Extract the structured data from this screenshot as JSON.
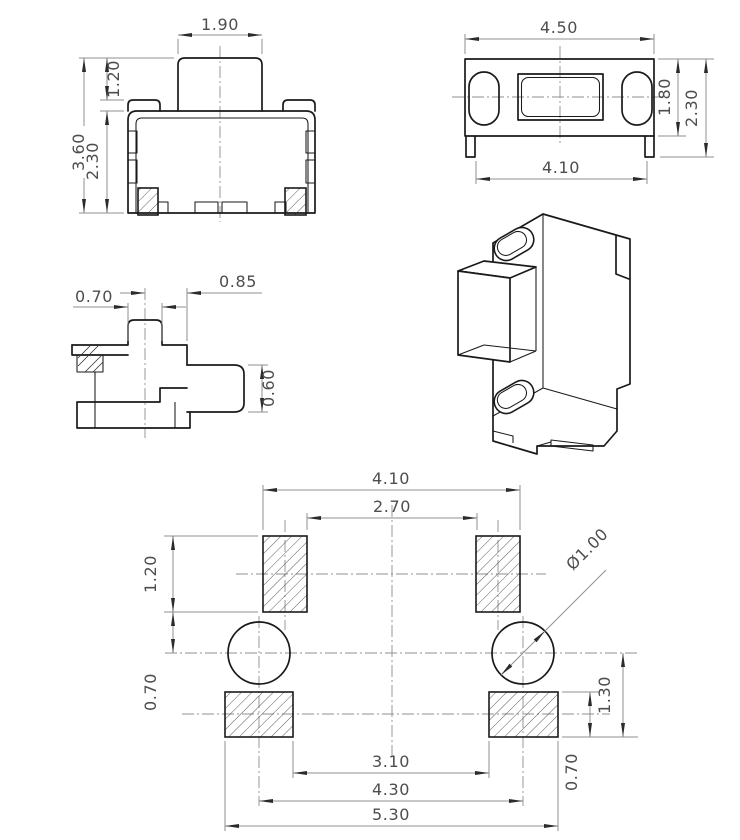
{
  "drawing": {
    "type": "engineering-drawing",
    "colors": {
      "background": "#ffffff",
      "object_line": "#1a1a1a",
      "dimension_line": "#8f8f8f",
      "dimension_text": "#4d4d4d",
      "centerline": "#8f8f8f",
      "hatch_line": "#333333",
      "arrowhead": "#2b2b2b"
    },
    "views": {
      "front": {
        "dims": {
          "button_width": "1.90",
          "button_height": "1.20",
          "overall_height": "3.60",
          "body_height": "2.30"
        }
      },
      "top": {
        "dims": {
          "overall_width": "4.50",
          "terminal_span": "4.10",
          "body_depth": "1.80",
          "overall_depth": "2.30"
        }
      },
      "side": {
        "dims": {
          "boss_width": "0.70",
          "center_to_face": "0.85",
          "stem_height": "0.60"
        }
      },
      "land": {
        "dims": {
          "pad_outer_span": "4.10",
          "pad_inner_span": "2.70",
          "pad_height": "1.20",
          "pad_to_hole_center": "0.70",
          "hole_diameter": "Ø1.00",
          "hole_center_to_pad_bottom": "1.30",
          "lower_pad_height": "0.70",
          "lower_pad_inner_span": "3.10",
          "lower_pad_pitch": "4.30",
          "lower_pad_outer_span": "5.30"
        }
      }
    }
  }
}
